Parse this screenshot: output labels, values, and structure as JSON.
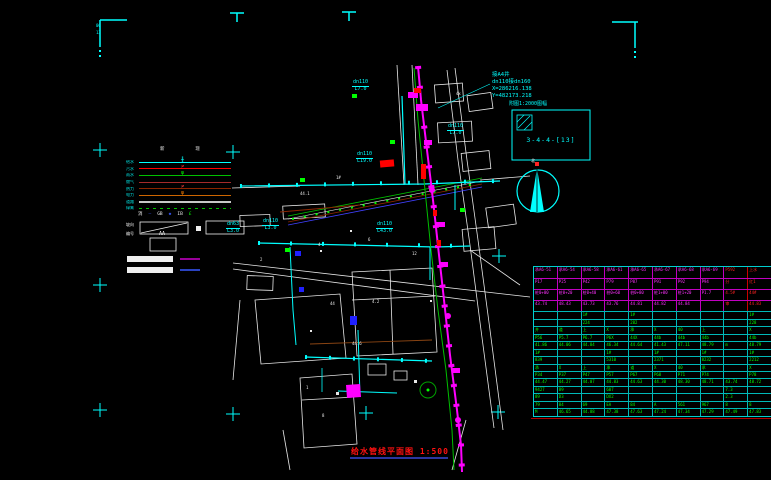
{
  "colors": {
    "background": "#000000",
    "cyan": "#00ffff",
    "magenta": "#ff00ff",
    "red": "#ff0000",
    "green": "#00ff00",
    "white": "#ffffff",
    "table_green": "#00ff00",
    "title_red": "#ff1111"
  },
  "title": {
    "text": "给水管线平面图 1:500"
  },
  "north": {
    "label": "北"
  },
  "detail_box": {
    "caption": "附图1:2000图幅",
    "code": "3-4-4-[13]"
  },
  "annotations": {
    "coord_block": [
      "接A4井",
      "dn110接dn160",
      "X=286216.138",
      "Y=482173.218"
    ],
    "pipe_labels": [
      {
        "size": "dn110",
        "len": "L7.0",
        "x": 352,
        "y": 80
      },
      {
        "size": "dn110",
        "len": "L19.0",
        "x": 356,
        "y": 152
      },
      {
        "size": "dn110",
        "len": "L7.0",
        "x": 447,
        "y": 124
      },
      {
        "size": "dn63",
        "len": "L3.0",
        "x": 226,
        "y": 222
      },
      {
        "size": "dn110",
        "len": "L3.0",
        "x": 262,
        "y": 219
      },
      {
        "size": "dn110",
        "len": "L43.0",
        "x": 376,
        "y": 222
      }
    ],
    "tiny_texts": [
      {
        "t": "06",
        "x": 96,
        "y": 24,
        "c": "#00ffff"
      },
      {
        "t": "13",
        "x": 96,
        "y": 31,
        "c": "#00ffff"
      },
      {
        "t": "1#",
        "x": 336,
        "y": 176
      },
      {
        "t": "44.1",
        "x": 300,
        "y": 192
      },
      {
        "t": "4",
        "x": 318,
        "y": 243
      },
      {
        "t": "6",
        "x": 368,
        "y": 238
      },
      {
        "t": "12",
        "x": 412,
        "y": 252
      },
      {
        "t": "2",
        "x": 260,
        "y": 258
      },
      {
        "t": "44",
        "x": 330,
        "y": 302
      },
      {
        "t": "4.2",
        "x": 372,
        "y": 300
      },
      {
        "t": "44.6",
        "x": 352,
        "y": 342
      },
      {
        "t": "1",
        "x": 306,
        "y": 386
      },
      {
        "t": "8",
        "x": 322,
        "y": 414
      },
      {
        "t": "4x",
        "x": 456,
        "y": 92
      }
    ]
  },
  "legend": {
    "headers": "新 现",
    "aa_prefix": "编号",
    "aa_label": "AA",
    "slope_label": "坡向",
    "rows": [
      {
        "label": "给水",
        "color": "#00ffff",
        "marker": "╫",
        "marker_color": "#00ffff"
      },
      {
        "label": "污水",
        "color": "#ff0000",
        "marker": "≠",
        "marker_color": "#ff3030"
      },
      {
        "label": "雨水",
        "color": "#00c000",
        "marker": "φ",
        "marker_color": "#00ff00"
      },
      {
        "label": "燃气",
        "color": "#a52a2a",
        "marker": "",
        "marker_color": ""
      },
      {
        "label": "热力",
        "color": "#8b2500",
        "marker": "≠",
        "marker_color": "#ff4040"
      },
      {
        "label": "电力",
        "color": "#cd6600",
        "marker": "φ",
        "marker_color": "#ff8000"
      },
      {
        "label": "道路",
        "color": "#c8c8c8",
        "thick": true
      },
      {
        "label": "绿篱",
        "color": "#00c000",
        "dashed": true
      }
    ],
    "symbols": [
      {
        "t": "消",
        "c": "#efefef"
      },
      {
        "t": "—",
        "c": "#3858ff"
      },
      {
        "t": "GB",
        "c": "#efefef"
      },
      {
        "t": "◆",
        "c": "#3858ff"
      },
      {
        "t": "IB",
        "c": "#efefef"
      },
      {
        "t": "£",
        "c": "#00ff00"
      }
    ]
  },
  "table": {
    "top_rows": [
      {
        "h": 11,
        "cells": [
          "承A6-51",
          "承A6-54",
          "承A6-58",
          "承A6-61",
          "承A6-65",
          "承A6-67",
          "承A6-68",
          "承A6-69",
          "P592",
          "上水"
        ]
      },
      {
        "h": 11,
        "cells": [
          "P17",
          "P25",
          "P42",
          "P79",
          "P87",
          "P91",
          "P92",
          "P94",
          "分",
          "红1"
        ]
      },
      {
        "h": 11,
        "cells": [
          "桩0+00",
          "桩0+20",
          "桩0+40",
          "桩0+60",
          "桩0+80",
          "桩1+00",
          "桩1+20",
          "P1.7",
          "4.5#",
          "44#"
        ]
      },
      {
        "h": 11,
        "cells": [
          "43.74",
          "48.43",
          "43.73",
          "43.76",
          "44.81",
          "44.82",
          "44.84",
          "",
          "审",
          "44.83"
        ]
      }
    ],
    "green_rows": [
      {
        "h": 8,
        "cells": [
          "",
          "",
          "1#",
          "",
          "1#",
          "",
          "",
          "",
          "",
          "1#"
        ]
      },
      {
        "h": 7,
        "cells": [
          "",
          "",
          "224",
          "",
          "282",
          "",
          "",
          "",
          "",
          "228"
        ]
      },
      {
        "h": 8,
        "cells": [
          "井",
          "道",
          "上",
          "X",
          "承",
          "X",
          "40",
          "上",
          "",
          "X"
        ]
      },
      {
        "h": 7,
        "cells": [
          "P56",
          "P5.7",
          "P6.7",
          "P6X",
          "44X",
          "44b",
          "44b",
          "44b",
          "",
          "44b"
        ]
      },
      {
        "h": 8,
        "cells": [
          "41.86",
          "44.06",
          "44.84",
          "46.34",
          "44.64",
          "41.43",
          "47.11",
          "48.79",
          "m",
          "48.79"
        ]
      },
      {
        "h": 7,
        "cells": [
          "1#",
          "",
          "",
          "1#",
          "",
          "1#",
          "",
          "1#",
          "",
          "1#"
        ]
      },
      {
        "h": 8,
        "cells": [
          "839",
          "",
          "",
          "5310",
          "",
          "2371",
          "",
          "8232",
          "",
          "2212"
        ]
      },
      {
        "h": 7,
        "cells": [
          "承",
          "X",
          "上",
          "承",
          "道",
          "X",
          "40",
          "承",
          "",
          "X"
        ]
      },
      {
        "h": 7,
        "cells": [
          "P34",
          "P37",
          "P47",
          "P57",
          "P67",
          "P68",
          "P71",
          "P74",
          "",
          "P78"
        ]
      },
      {
        "h": 8,
        "cells": [
          "44.47",
          "44.27",
          "44.07",
          "44.83",
          "44.63",
          "44.30",
          "48.30",
          "48.71",
          "43.74",
          "48.72"
        ]
      },
      {
        "h": 7,
        "cells": [
          "9427",
          "89",
          "",
          "607",
          "",
          "",
          "",
          "",
          "7.3",
          ""
        ]
      },
      {
        "h": 8,
        "cells": [
          "89",
          "D3",
          "",
          "DX2",
          "",
          "",
          "",
          "",
          "2.3",
          ""
        ]
      },
      {
        "h": 7,
        "cells": [
          "79",
          "84",
          "69",
          "EA",
          "84",
          "A",
          "561",
          "967",
          "8",
          "8"
        ]
      },
      {
        "h": 8,
        "cells": [
          "M",
          "46.65",
          "44.88",
          "47.38",
          "47.63",
          "47.24",
          "47.34",
          "47.29",
          "47.49",
          "47.83"
        ]
      }
    ]
  }
}
